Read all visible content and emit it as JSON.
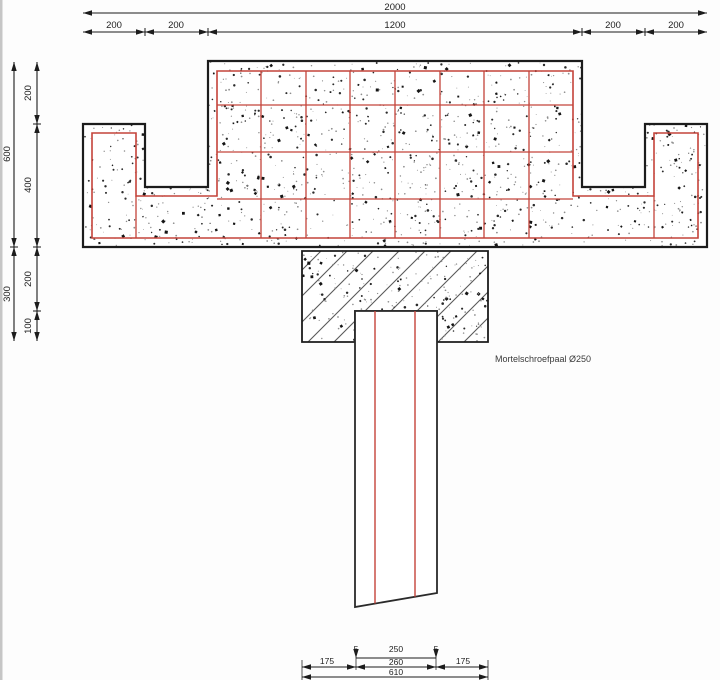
{
  "diagram": {
    "annotation": "Mortelschroefpaal Ø250",
    "colors": {
      "outline": "#1c1c1c",
      "rebar_red": "#c4433a",
      "hatch": "#5a5a5a",
      "background": "#fdfdfd",
      "edge_shadow": "#c6c6c6"
    },
    "top_dims": {
      "total": "2000",
      "segments": [
        "200",
        "200",
        "1200",
        "200",
        "200"
      ]
    },
    "left_dims": {
      "outer": [
        "600",
        "300"
      ],
      "inner": [
        "200",
        "400",
        "200",
        "100"
      ]
    },
    "bottom_dims": {
      "row1": [
        "175",
        "5",
        "250",
        "5",
        "175"
      ],
      "row2": "260",
      "row3": "610"
    }
  }
}
